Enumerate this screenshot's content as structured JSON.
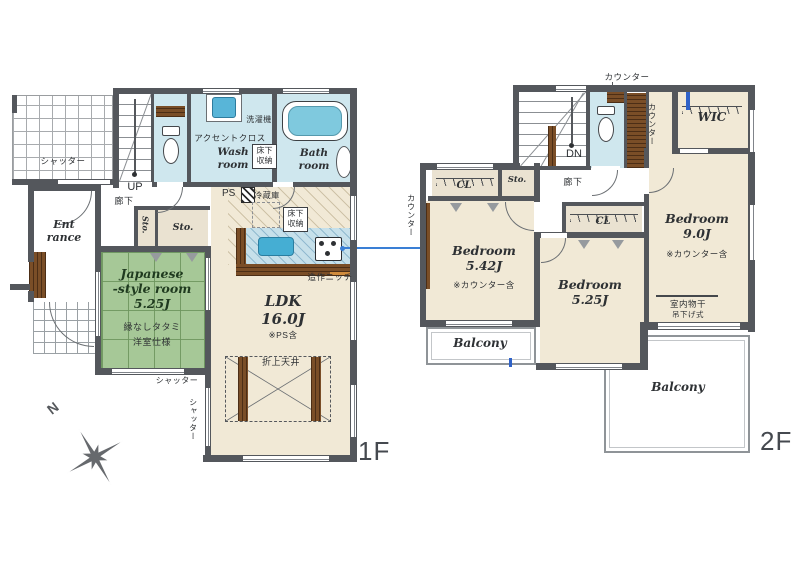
{
  "f1": {
    "floor_label": "1F",
    "compass_north": "N",
    "shutter_garage": "シャッター",
    "stairs_up": "UP",
    "corridor": "廊下",
    "entrance_line1": "Ent",
    "entrance_line2": "rance",
    "storage_small": "Sto.",
    "storage_large": "Sto.",
    "accent_cloth": "アクセントクロス",
    "washing_machine": "洗濯機",
    "wash_room_line1": "Wash",
    "wash_room_line2": "room",
    "underfloor_storage_wash_line1": "床下",
    "underfloor_storage_wash_line2": "収納",
    "bath_room_line1": "Bath",
    "bath_room_line2": "room",
    "pipe_space": "PS",
    "refrigerator": "冷蔵庫",
    "underfloor_storage_kitchen_line1": "床下",
    "underfloor_storage_kitchen_line2": "収納",
    "built_in_niche": "造作ニッチ",
    "ldk_name": "LDK",
    "ldk_size": "16.0J",
    "ldk_note": "※PS含",
    "jp_room_line1": "Japanese",
    "jp_room_line2": "-style room",
    "jp_room_size": "5.25J",
    "jp_room_note1": "縁なしタタミ",
    "jp_room_note2": "洋室仕様",
    "coffered_ceiling": "折上天井",
    "shutter_south": "シャッター",
    "shutter_west": "シャッター"
  },
  "f2": {
    "floor_label": "2F",
    "counter_toilet": "カウンター",
    "counter_bedroom542": "カウンター",
    "counter_hall": "カウンター",
    "stairs_down": "DN",
    "corridor": "廊下",
    "storage": "Sto.",
    "closet_542": "CL",
    "closet_525": "CL",
    "wic": "WIC",
    "bedroom542_name": "Bedroom",
    "bedroom542_size": "5.42J",
    "bedroom542_note": "※カウンター含",
    "bedroom525_name": "Bedroom",
    "bedroom525_size": "5.25J",
    "bedroom90_name": "Bedroom",
    "bedroom90_size": "9.0J",
    "bedroom90_note": "※カウンター含",
    "indoor_drying_line1": "室内物干",
    "indoor_drying_line2": "吊下げ式",
    "balcony_left": "Balcony",
    "balcony_right": "Balcony"
  },
  "colors": {
    "wall": "#54575c",
    "floor_beige": "#f1e9d6",
    "tatami_green": "#a6c897",
    "water_blue": "#cfe7ee",
    "tub_blue": "#7fc9de",
    "wood_brown": "#7a4e27",
    "accent_blue": "#3a7fd5"
  }
}
